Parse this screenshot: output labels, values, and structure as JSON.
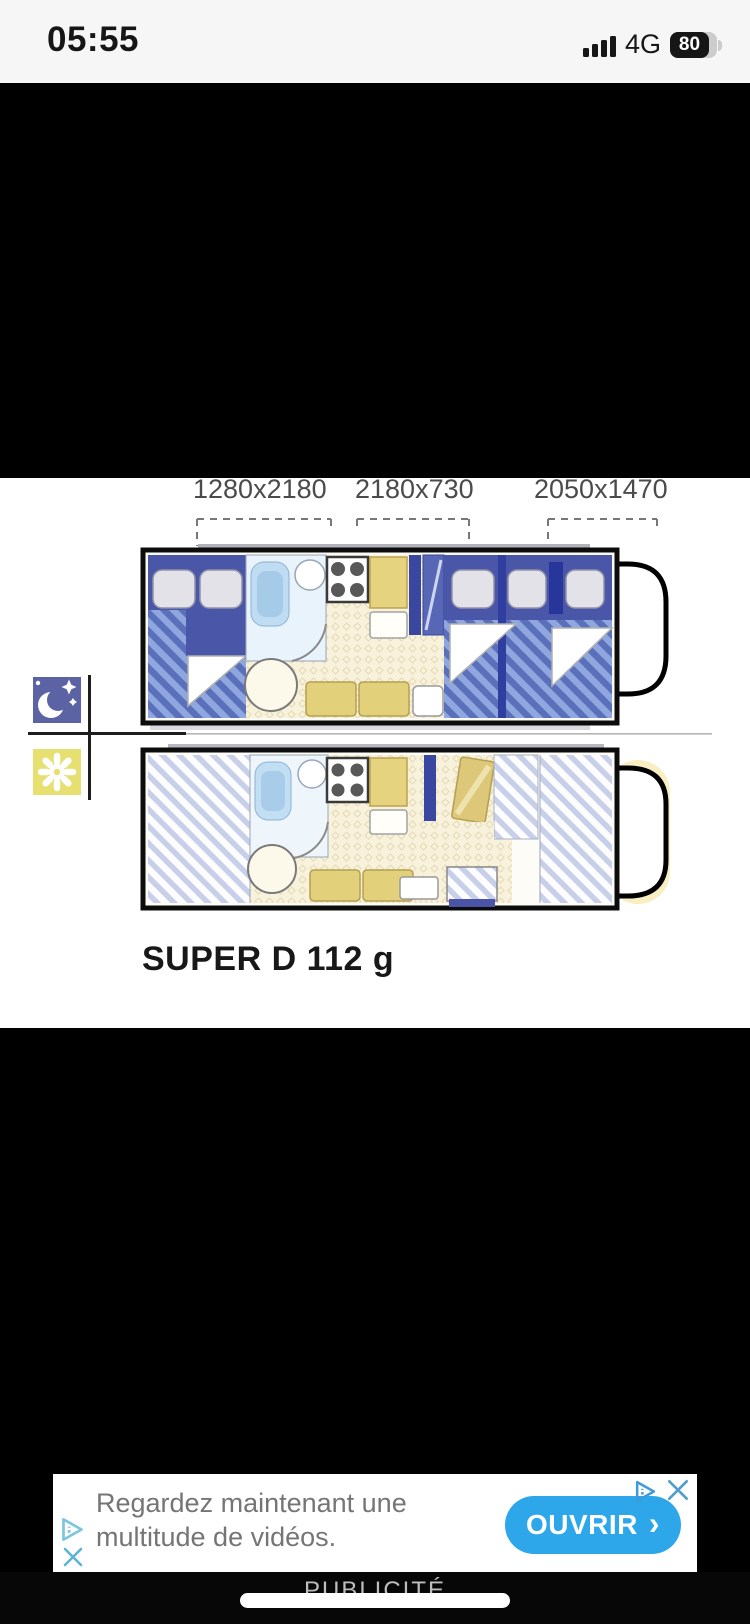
{
  "status_bar": {
    "time": "05:55",
    "network": "4G",
    "battery_percent": "80"
  },
  "figure": {
    "bed_dimensions": [
      "1280x2180",
      "2180x730",
      "2050x1470"
    ],
    "model_name": "SUPER D 112 g",
    "mode_icons": {
      "night": "moon-stars",
      "day": "sun"
    },
    "colors": {
      "night_blue": "#4a57a8",
      "night_stripe_light": "#8fa6de",
      "day_stripe": "#c7cfe9",
      "furniture_yellow": "#e6d37f",
      "floor_cream": "#f8f2dc",
      "moon_bg": "#5b63a5",
      "sun_bg": "#e7df70"
    }
  },
  "ad": {
    "line1": "Regardez maintenant une",
    "line2": "multitude de vidéos.",
    "cta_label": "OUVRIR",
    "cta_chevron": "›",
    "cta_color": "#2ea7ea",
    "footer_label": "PUBLICITÉ",
    "icons": {
      "adchoices": "play-triangle-i",
      "close": "x",
      "home": "pill"
    }
  }
}
